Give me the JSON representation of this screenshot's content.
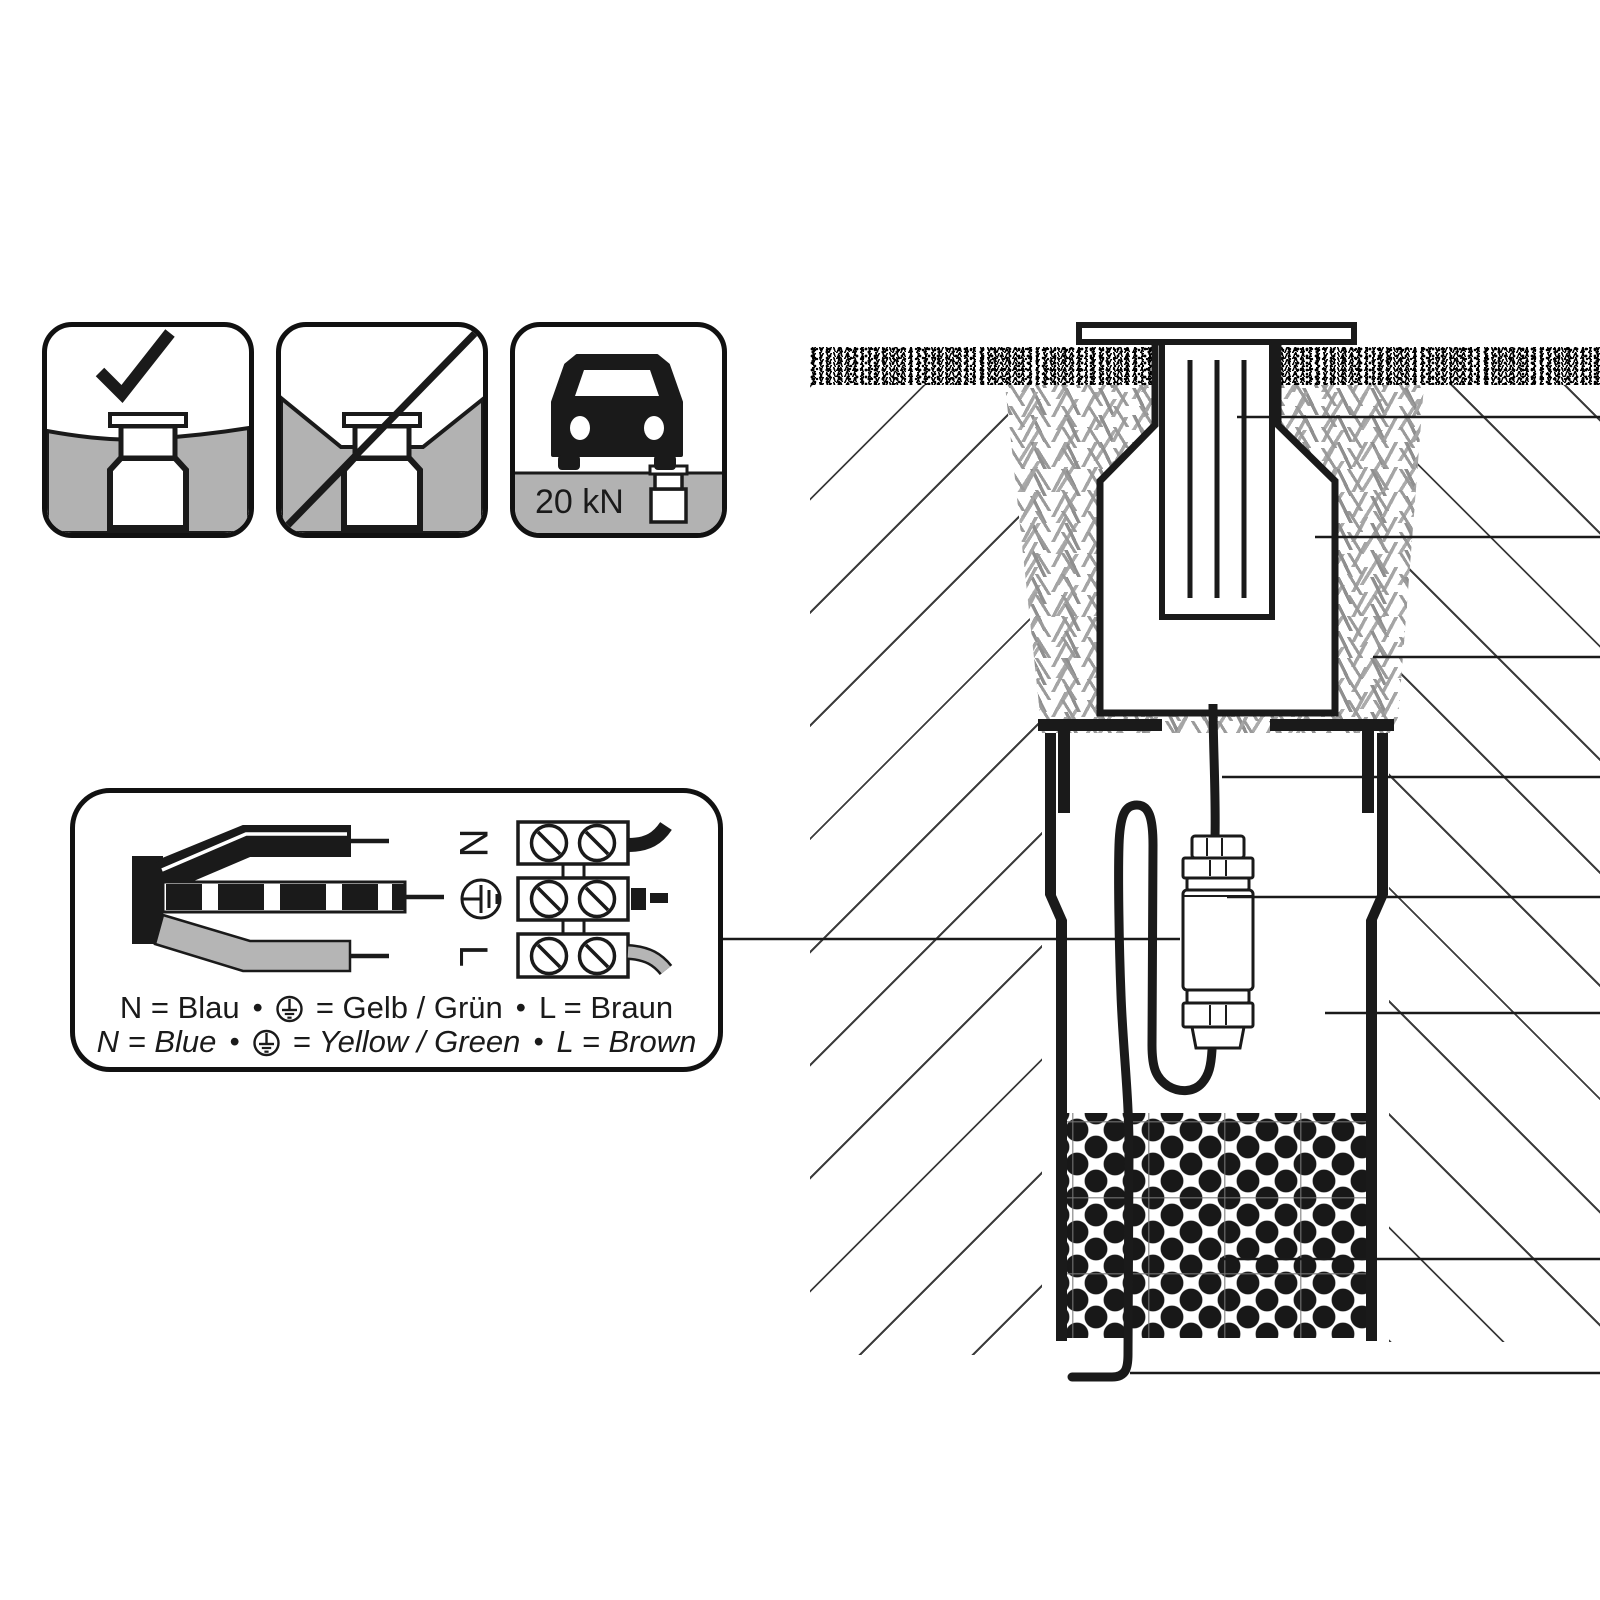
{
  "title": "In-ground luminaire installation diagram",
  "icons": {
    "correct": {
      "name": "flush-installation-allowed"
    },
    "incorrect": {
      "name": "installation-in-depression-not-allowed"
    },
    "load_rating": {
      "label": "20 kN"
    }
  },
  "wiring": {
    "terminals": {
      "n": "N",
      "l": "L"
    },
    "bullet": "•",
    "caption_de": {
      "n": "N = Blau",
      "pe": "= Gelb / Grün",
      "l": "L = Braun"
    },
    "caption_en": {
      "n": "N = Blue",
      "pe": "= Yellow / Green",
      "l": "L = Brown"
    }
  },
  "colors": {
    "ink": "#1a1a1a",
    "ground-gray": "#b2b2b2",
    "wire-gray": "#b5b5b5",
    "hatch-gray": "#3c3c3c"
  }
}
